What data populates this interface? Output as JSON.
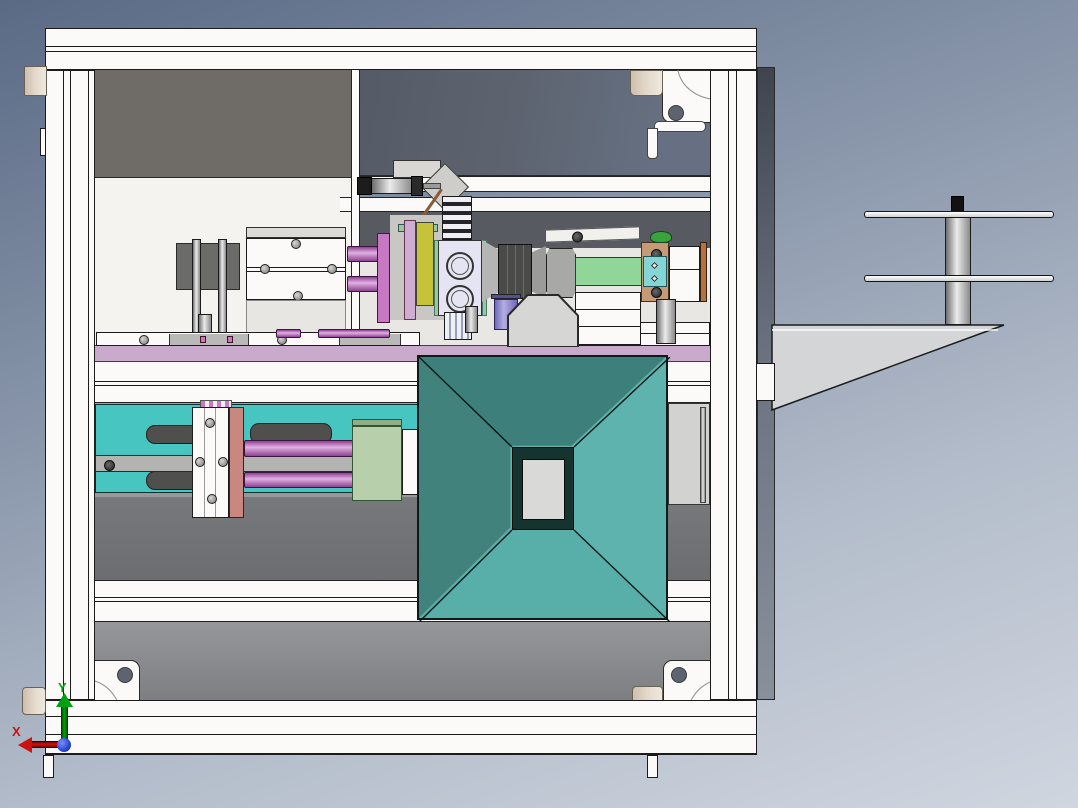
{
  "triad": {
    "x_label": "X",
    "y_label": "Y"
  },
  "colors": {
    "bg_top": "#5a6a85",
    "bg_bottom": "#d0d6e0",
    "frame_white": "#fbfaf8",
    "panel_dark_warm": "#6f6b66",
    "panel_blue_gray": "#5d6470",
    "panel_white": "#f5f3ef",
    "panel_machine": "#e9e7e4",
    "panel_lower_top": "#a0a2a4",
    "panel_lower_bottom": "#7e8083",
    "band_dark": "#6b6d70",
    "shelf_purple": "#c9a9cc",
    "funnel_top": "#3c7f7b",
    "funnel_left": "#42827d",
    "funnel_right": "#5fb3ae",
    "funnel_bottom": "#58aea9",
    "funnel_frame": "#15332f",
    "funnel_center": "#d9dad8",
    "plate_teal": "#47c5c1",
    "rod_purple_dark": "#8e4292",
    "rod_purple_light": "#e0b0e2",
    "plate_salmon": "#c98780",
    "block_sage": "#b7cfab",
    "block_sage_dark": "#8fae85",
    "plate_yellow": "#c6c23c",
    "plate_magenta": "#c678c2",
    "strip_mauve": "#cfadd2",
    "strip_green": "#9cc79e",
    "bar_green": "#8fd698",
    "plate_tan": "#c59b77",
    "plate_cyan": "#84d5d6",
    "knob_green": "#3aa43c",
    "strip_brown": "#b5713f",
    "cyl_purple_light": "#b3aee0",
    "cyl_purple_dark": "#6f68b8",
    "lavender_block": "#e4e4f2",
    "block_dark": "#4a4a48",
    "beige": "#e5dbcd",
    "needle_brown": "#8a5a38",
    "bracket_gray": "#d3d5d7",
    "side_strip_top": "#3f444e",
    "side_strip_bottom": "#88909c",
    "triad_x_red": "#cc1111",
    "triad_y_green": "#00a013",
    "triad_origin_blue": "#2747cf"
  }
}
